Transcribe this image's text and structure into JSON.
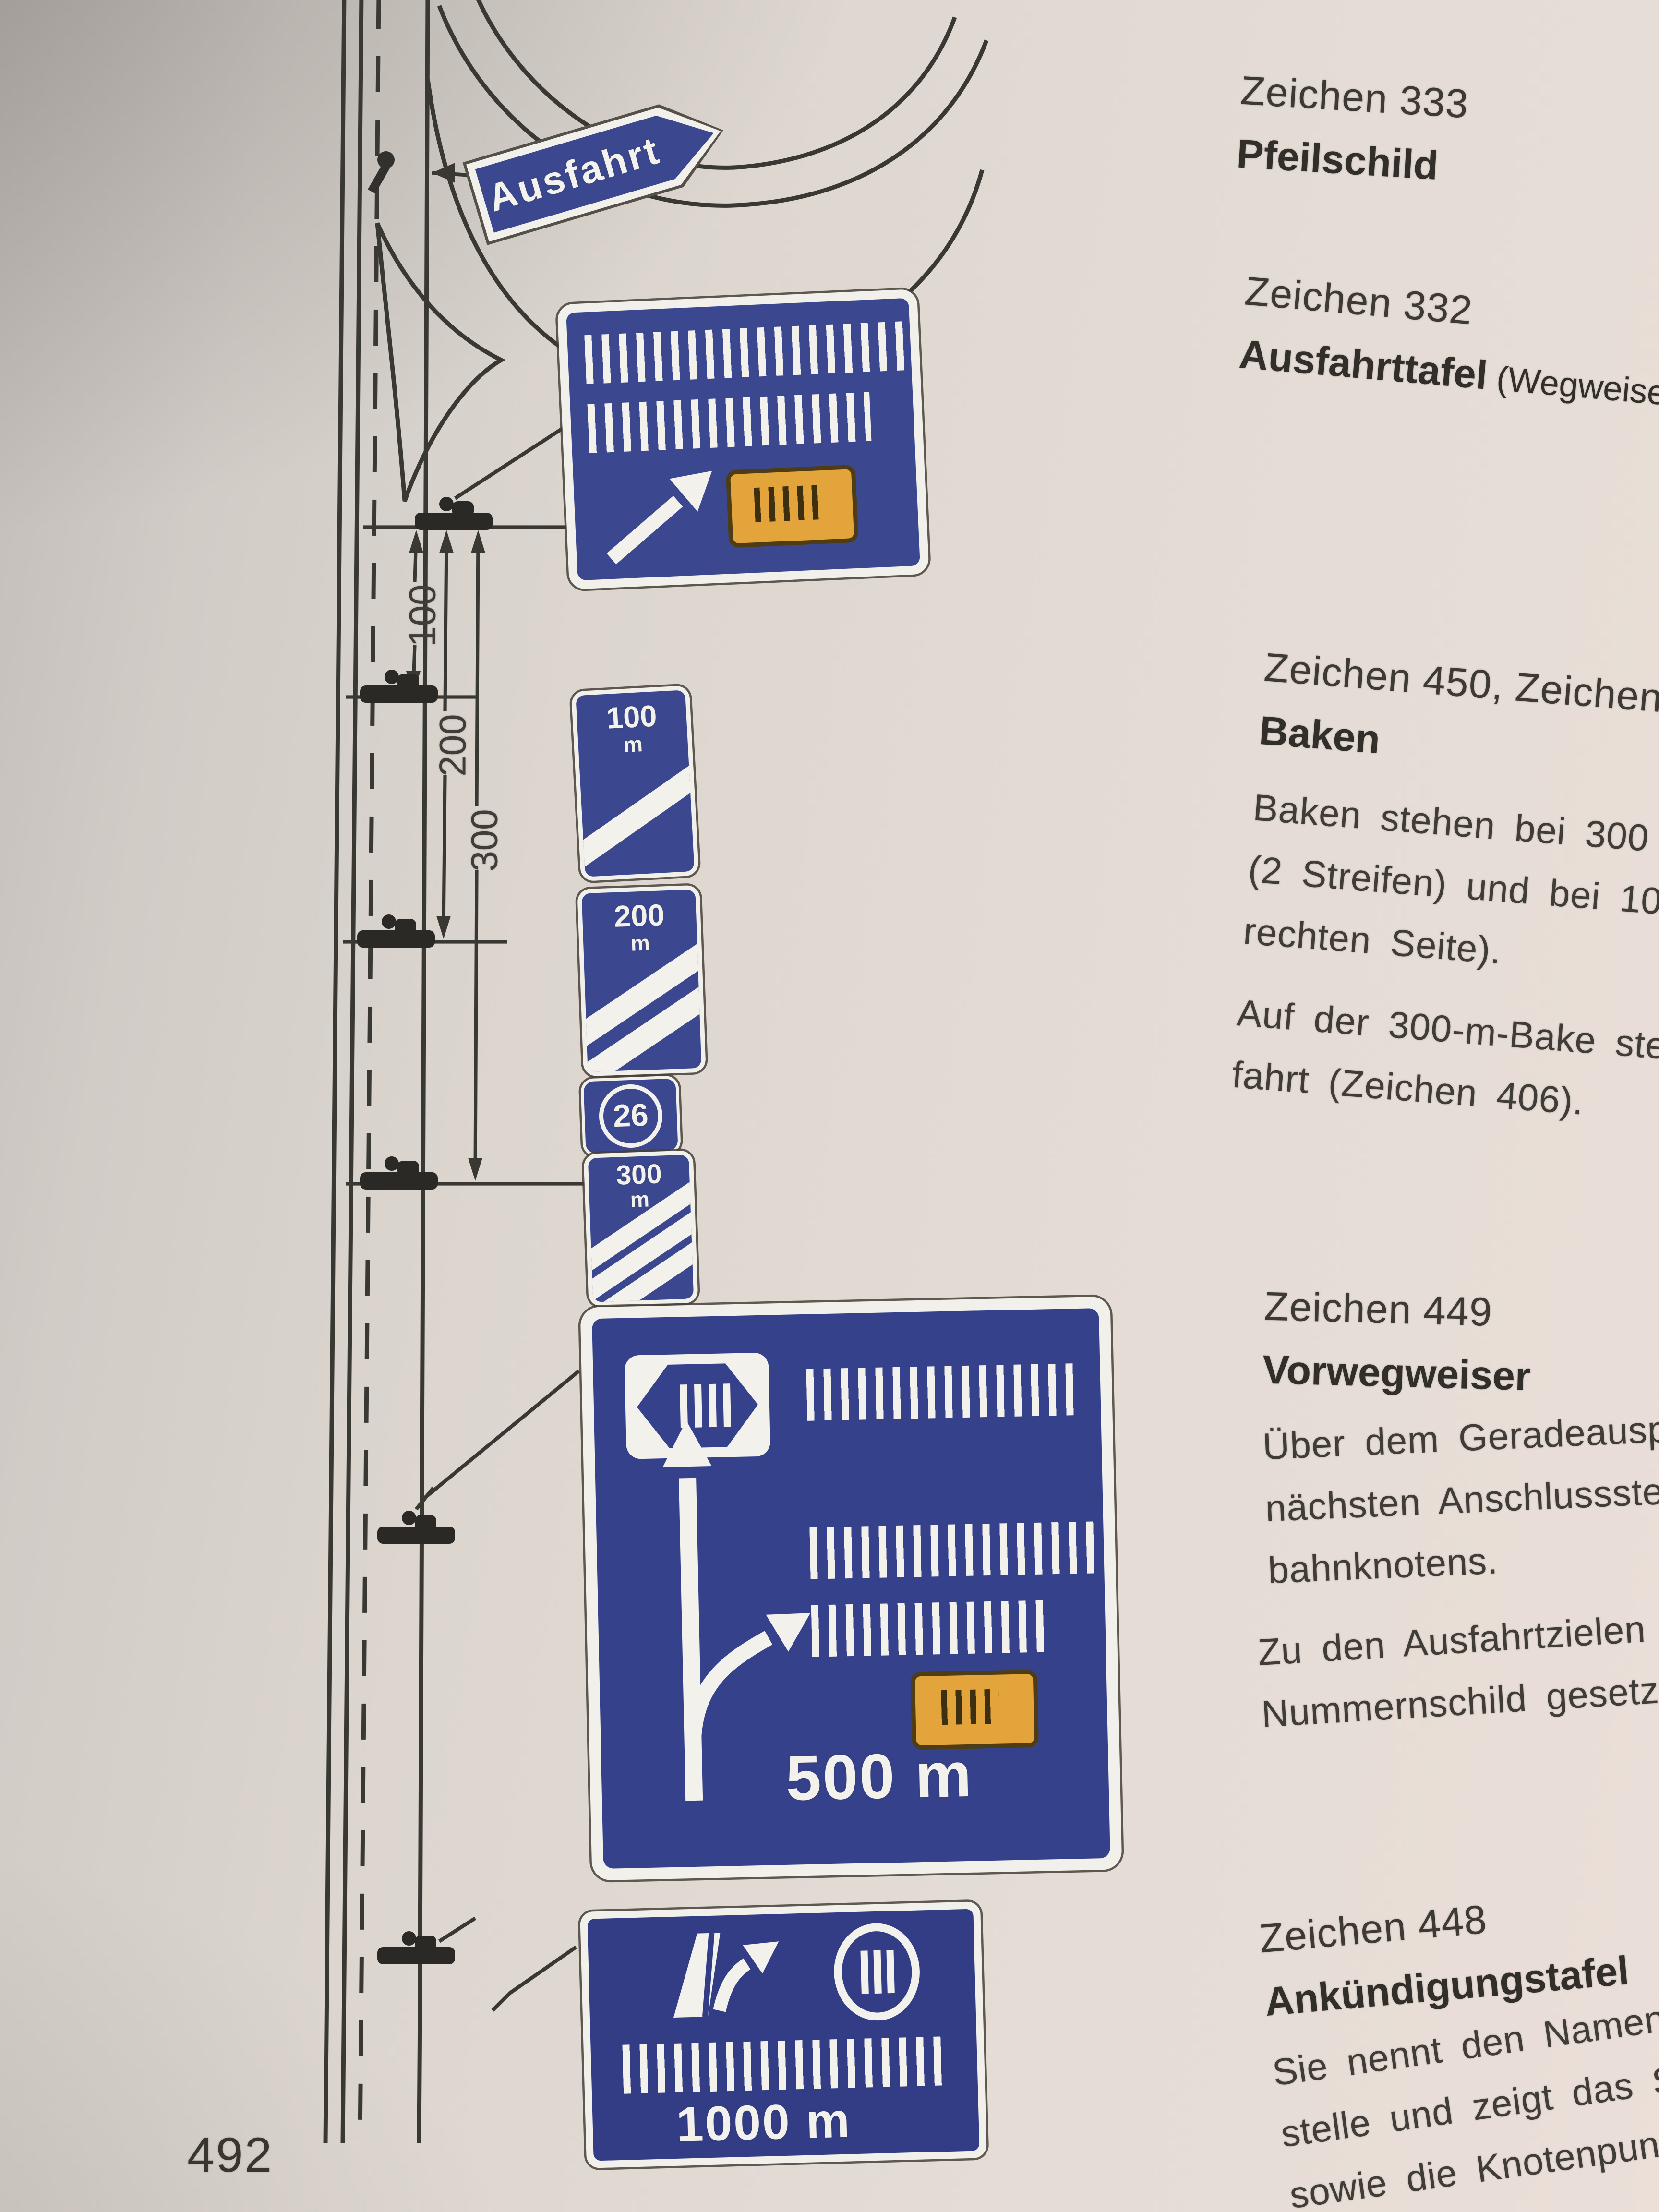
{
  "page": {
    "number": "492"
  },
  "right_column": {
    "block_333": {
      "zeichen": "Zeichen 333",
      "title": "Pfeilschild"
    },
    "block_332": {
      "zeichen": "Zeichen 332",
      "title": "Ausfahrttafel",
      "title_suffix": " (Wegweiser)"
    },
    "block_450": {
      "zeichen": "Zeichen 450, Zeichen 451, Z",
      "title": "Baken",
      "para1": [
        "Baken stehen bei 300 m (3",
        "(2 Streifen) und bei 100 m (1",
        "rechten Seite)."
      ],
      "para2": [
        "Auf der 300-m-Bake steht d",
        "fahrt (Zeichen 406)."
      ]
    },
    "block_449": {
      "zeichen": "Zeichen 449",
      "title": "Vorwegweiser",
      "para1": [
        "Über dem Geradeauspfeil",
        "nächsten Anschlussstelle od",
        "bahnknotens."
      ],
      "para2": [
        "Zu den Ausfahrtzielen kann",
        "Nummernschild gesetzt we"
      ]
    },
    "block_448": {
      "zeichen": "Zeichen 448",
      "title": "Ankündigungstafel",
      "para1": [
        "Sie nennt den Namen der",
        "stelle und zeigt das Sinnbi",
        "sowie die Knotenpunktnum"
      ]
    }
  },
  "diagram": {
    "ausfahrt_sign": {
      "label": "Ausfahrt",
      "shape": "arrow-pentagon"
    },
    "ausfahrttafel": {
      "tick_rows": [
        20,
        17
      ],
      "has_diagonal_arrow": true,
      "orange_badge_ticks": 5
    },
    "baken": [
      {
        "label": "100",
        "unit": "m",
        "stripes": 1
      },
      {
        "label": "200",
        "unit": "m",
        "stripes": 2
      },
      {
        "label": "300",
        "unit": "m",
        "stripes": 3
      }
    ],
    "route_badge": {
      "number": "26"
    },
    "vorwegweiser": {
      "distance": "500 m",
      "tick_rows": [
        16,
        17,
        14
      ],
      "motorway_badge_ticks": 4,
      "orange_badge_ticks": 4
    },
    "ankuendigungstafel": {
      "distance": "1000 m",
      "tick_rows": [
        19
      ],
      "oval_badge_ticks": 3
    },
    "dimension_labels": [
      "100",
      "200",
      "300"
    ],
    "colors": {
      "sign_blue": "#3b4890",
      "badge_orange": "#e3a43c",
      "paper": "#ded8d1",
      "ink": "#3b3733"
    }
  }
}
